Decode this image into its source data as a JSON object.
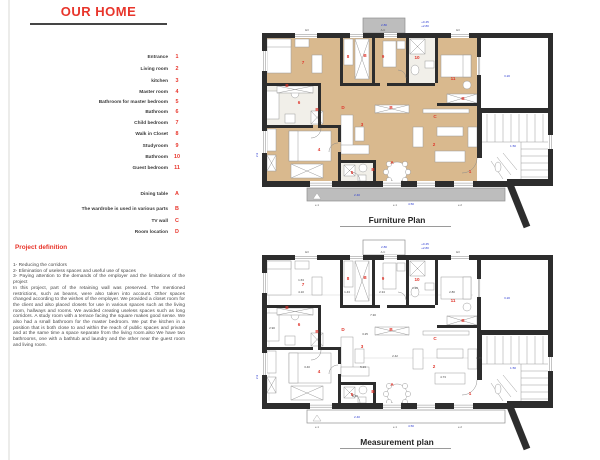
{
  "page": {
    "title": "OUR HOME"
  },
  "colors": {
    "red": "#e0352b",
    "blue": "#2b3bd0",
    "wall": "#2d2d2d",
    "wood": "#d9b98e",
    "gray": "#bdbdbd",
    "tile": "#f1efe9"
  },
  "legend": {
    "numbered": [
      {
        "label": "Entrance",
        "num": "1",
        "y": 58
      },
      {
        "label": "Living room",
        "num": "2",
        "y": 70
      },
      {
        "label": "kitchen",
        "num": "3",
        "y": 82
      },
      {
        "label": "Master room",
        "num": "4",
        "y": 93
      },
      {
        "label": "Bathroom for master bedroom",
        "num": "5",
        "y": 103
      },
      {
        "label": "Bathroom",
        "num": "6",
        "y": 113
      },
      {
        "label": "Child bedroom",
        "num": "7",
        "y": 124
      },
      {
        "label": "Walk in Closet",
        "num": "8",
        "y": 135
      },
      {
        "label": "Studyroom",
        "num": "9",
        "y": 147
      },
      {
        "label": "Bathroom",
        "num": "10",
        "y": 158
      },
      {
        "label": "Guest bedroom",
        "num": "11",
        "y": 169
      }
    ],
    "lettered": [
      {
        "label": "Dining table",
        "num": "A",
        "y": 195
      },
      {
        "label": "The wardrobe is used in various parts",
        "num": "B",
        "y": 210
      },
      {
        "label": "TV wall",
        "num": "C",
        "y": 222
      },
      {
        "label": "Room location",
        "num": "D",
        "y": 233
      }
    ]
  },
  "project": {
    "heading": "Project definition",
    "list": [
      "1- Reducing the corridors",
      "2- Elimination of useless spaces and useful use of spaces",
      "3- Paying attention to the demands of the employer and the limitations of the project"
    ],
    "body": "In this project, part of the retaining wall was preserved. The mentioned restrictions, such as beams, were also taken into account. Other spaces changed according to the wishes of the employer. We provided a closet room for the client and also placed closets for use in various spaces such as the living room, hallways and rooms. We avoided creating useless spaces such as long corridors. A study room with a terrace facing the square makes good sense. We also had a small bathroom for the master bedroom. We put the kitchen in a position that is both close to and within the reach of public spaces and private and at the same time a space separate from the living room.also We have two bathrooms, one with a bathtub and laundry and the other near the guest room and living room."
  },
  "plans": [
    {
      "id": "furniture",
      "label": "Furniture Plan",
      "origin": [
        255,
        15
      ],
      "filled": true
    },
    {
      "id": "measurement",
      "label": "Measurement plan",
      "origin": [
        255,
        237
      ],
      "filled": false
    }
  ],
  "room_labels": [
    {
      "t": "7",
      "x": 48,
      "y": 49
    },
    {
      "t": "8",
      "x": 93,
      "y": 43
    },
    {
      "t": "B",
      "x": 110,
      "y": 42
    },
    {
      "t": "9",
      "x": 128,
      "y": 43
    },
    {
      "t": "10",
      "x": 162,
      "y": 44
    },
    {
      "t": "11",
      "x": 198,
      "y": 65
    },
    {
      "t": "B",
      "x": 32,
      "y": 72
    },
    {
      "t": "6",
      "x": 44,
      "y": 89
    },
    {
      "t": "B",
      "x": 62,
      "y": 96
    },
    {
      "t": "D",
      "x": 88,
      "y": 94
    },
    {
      "t": "B",
      "x": 136,
      "y": 94
    },
    {
      "t": "C",
      "x": 180,
      "y": 103
    },
    {
      "t": "B",
      "x": 208,
      "y": 85
    },
    {
      "t": "3",
      "x": 107,
      "y": 111
    },
    {
      "t": "2",
      "x": 179,
      "y": 131
    },
    {
      "t": "4",
      "x": 64,
      "y": 136
    },
    {
      "t": "5",
      "x": 97,
      "y": 159
    },
    {
      "t": "B",
      "x": 118,
      "y": 156
    },
    {
      "t": "A",
      "x": 137,
      "y": 149
    },
    {
      "t": "1",
      "x": 215,
      "y": 158
    }
  ],
  "annotations": [
    {
      "t": "2.80",
      "x": 129,
      "y": 11
    },
    {
      "t": "+0.45",
      "x": 170,
      "y": 8
    },
    {
      "t": "+2.80",
      "x": 170,
      "y": 12
    },
    {
      "t": "3.20",
      "x": 252,
      "y": 62
    },
    {
      "t": "2.9",
      "x": 3,
      "y": 140,
      "r": true
    },
    {
      "t": "1.50",
      "x": 258,
      "y": 132
    },
    {
      "t": "2.40",
      "x": 102,
      "y": 181
    },
    {
      "t": "4.50",
      "x": 156,
      "y": 190
    }
  ],
  "tags": [
    {
      "t": "E3",
      "x": 52,
      "y": 16
    },
    {
      "t": "A.C",
      "x": 128,
      "y": 16
    },
    {
      "t": "E3",
      "x": 203,
      "y": 16
    },
    {
      "t": "e.1",
      "x": 62,
      "y": 191
    },
    {
      "t": "e.1",
      "x": 140,
      "y": 191
    },
    {
      "t": "e.2",
      "x": 205,
      "y": 191
    }
  ],
  "dims": [
    {
      "t": "4.10",
      "x": 46,
      "y": 56
    },
    {
      "t": "1.43",
      "x": 92,
      "y": 56
    },
    {
      "t": "2.34",
      "x": 127,
      "y": 56
    },
    {
      "t": "1.20",
      "x": 160,
      "y": 52
    },
    {
      "t": "2.80",
      "x": 197,
      "y": 56
    },
    {
      "t": "7.30",
      "x": 118,
      "y": 79
    },
    {
      "t": "3.25",
      "x": 110,
      "y": 98
    },
    {
      "t": "5.23",
      "x": 108,
      "y": 131
    },
    {
      "t": "2.90",
      "x": 17,
      "y": 92
    },
    {
      "t": "3.40",
      "x": 52,
      "y": 131
    },
    {
      "t": "4.73",
      "x": 188,
      "y": 141
    },
    {
      "t": "2.10",
      "x": 100,
      "y": 160
    },
    {
      "t": "1.85",
      "x": 224,
      "y": 122
    },
    {
      "t": "2.42",
      "x": 140,
      "y": 120
    },
    {
      "t": "1.63",
      "x": 46,
      "y": 44
    }
  ],
  "geometry": {
    "floor": {
      "x": 12,
      "y": 23,
      "w": 210,
      "h": 143
    },
    "tiles": [
      {
        "x": 12,
        "y": 71,
        "w": 51,
        "h": 39
      },
      {
        "x": 154,
        "y": 23,
        "w": 26,
        "h": 45
      },
      {
        "x": 86,
        "y": 148,
        "w": 32,
        "h": 18
      }
    ],
    "terrace": {
      "x": 108,
      "y": 3,
      "w": 42,
      "h": 15
    },
    "balcony": {
      "x": 52,
      "y": 173,
      "w": 198,
      "h": 13
    },
    "walls": [
      {
        "x": 7,
        "y": 18,
        "w": 291,
        "h": 5
      },
      {
        "x": 7,
        "y": 18,
        "w": 5,
        "h": 154
      },
      {
        "x": 7,
        "y": 166,
        "w": 246,
        "h": 6
      },
      {
        "x": 293,
        "y": 18,
        "w": 5,
        "h": 80
      },
      {
        "x": 222,
        "y": 93,
        "w": 76,
        "h": 5
      },
      {
        "x": 222,
        "y": 93,
        "w": 5,
        "h": 50
      },
      {
        "x": 293,
        "y": 93,
        "w": 5,
        "h": 77
      },
      {
        "x": 252,
        "y": 164,
        "w": 46,
        "h": 7
      },
      {
        "x": 222,
        "y": 18,
        "w": 4,
        "h": 77
      },
      {
        "x": 85,
        "y": 20,
        "w": 3,
        "h": 48
      },
      {
        "x": 117,
        "y": 20,
        "w": 3,
        "h": 48
      },
      {
        "x": 151,
        "y": 20,
        "w": 3,
        "h": 48
      },
      {
        "x": 180,
        "y": 20,
        "w": 3,
        "h": 48
      },
      {
        "x": 10,
        "y": 68,
        "w": 55,
        "h": 3
      },
      {
        "x": 63,
        "y": 68,
        "w": 3,
        "h": 45
      },
      {
        "x": 85,
        "y": 68,
        "w": 40,
        "h": 3
      },
      {
        "x": 132,
        "y": 68,
        "w": 48,
        "h": 3
      },
      {
        "x": 182,
        "y": 88,
        "w": 40,
        "h": 3
      },
      {
        "x": 10,
        "y": 110,
        "w": 48,
        "h": 3
      },
      {
        "x": 66,
        "y": 110,
        "w": 17,
        "h": 3
      },
      {
        "x": 83,
        "y": 110,
        "w": 3,
        "h": 17
      },
      {
        "x": 83,
        "y": 137,
        "w": 3,
        "h": 31
      },
      {
        "x": 118,
        "y": 145,
        "w": 3,
        "h": 23
      },
      {
        "x": 86,
        "y": 145,
        "w": 35,
        "h": 3
      }
    ],
    "diag": {
      "x1": 254,
      "y1": 167,
      "x2": 272,
      "y2": 212,
      "w": 7
    },
    "windows": [
      {
        "x": 40,
        "y": 18,
        "w": 22,
        "h": 5,
        "o": "h"
      },
      {
        "x": 95,
        "y": 18,
        "w": 13,
        "h": 5,
        "o": "h"
      },
      {
        "x": 129,
        "y": 18,
        "w": 13,
        "h": 5,
        "o": "h"
      },
      {
        "x": 196,
        "y": 18,
        "w": 18,
        "h": 5,
        "o": "h"
      },
      {
        "x": 7,
        "y": 36,
        "w": 5,
        "h": 20,
        "o": "v"
      },
      {
        "x": 7,
        "y": 116,
        "w": 5,
        "h": 22,
        "o": "v"
      },
      {
        "x": 55,
        "y": 166,
        "w": 22,
        "h": 6,
        "o": "h"
      },
      {
        "x": 128,
        "y": 166,
        "w": 18,
        "h": 6,
        "o": "h"
      },
      {
        "x": 162,
        "y": 166,
        "w": 18,
        "h": 6,
        "o": "h"
      },
      {
        "x": 199,
        "y": 166,
        "w": 19,
        "h": 6,
        "o": "h"
      },
      {
        "x": 222,
        "y": 42,
        "w": 4,
        "h": 18,
        "o": "v"
      },
      {
        "x": 293,
        "y": 120,
        "w": 5,
        "h": 14,
        "o": "v"
      }
    ],
    "furniture": [
      {
        "k": "r",
        "x": 12,
        "y": 24,
        "w": 24,
        "h": 34
      },
      {
        "k": "r",
        "x": 12,
        "y": 24,
        "w": 24,
        "h": 8
      },
      {
        "k": "r",
        "x": 40,
        "y": 24,
        "w": 14,
        "h": 8
      },
      {
        "k": "r",
        "x": 57,
        "y": 40,
        "w": 10,
        "h": 18
      },
      {
        "k": "x",
        "x": 100,
        "y": 24,
        "w": 14,
        "h": 40
      },
      {
        "k": "r",
        "x": 89,
        "y": 24,
        "w": 9,
        "h": 26
      },
      {
        "k": "r",
        "x": 128,
        "y": 26,
        "w": 13,
        "h": 26
      },
      {
        "k": "r",
        "x": 142,
        "y": 26,
        "w": 8,
        "h": 8
      },
      {
        "k": "x",
        "x": 155,
        "y": 24,
        "w": 15,
        "h": 15
      },
      {
        "k": "e",
        "cx": 160,
        "cy": 55,
        "rx": 4,
        "ry": 5
      },
      {
        "k": "r",
        "x": 170,
        "y": 46,
        "w": 9,
        "h": 7
      },
      {
        "k": "r",
        "x": 186,
        "y": 40,
        "w": 30,
        "h": 22
      },
      {
        "k": "r",
        "x": 208,
        "y": 40,
        "w": 8,
        "h": 22
      },
      {
        "k": "e",
        "cx": 212,
        "cy": 70,
        "rx": 4,
        "ry": 4
      },
      {
        "k": "r",
        "x": 11,
        "y": 76,
        "w": 13,
        "h": 28
      },
      {
        "k": "e",
        "cx": 40,
        "cy": 78,
        "rx": 4,
        "ry": 5
      },
      {
        "k": "r",
        "x": 30,
        "y": 99,
        "w": 10,
        "h": 9
      },
      {
        "k": "x",
        "x": 22,
        "y": 71,
        "w": 36,
        "h": 7
      },
      {
        "k": "x",
        "x": 56,
        "y": 96,
        "w": 12,
        "h": 13
      },
      {
        "k": "r",
        "x": 34,
        "y": 116,
        "w": 42,
        "h": 30
      },
      {
        "k": "r",
        "x": 34,
        "y": 116,
        "w": 9,
        "h": 30
      },
      {
        "k": "x",
        "x": 36,
        "y": 149,
        "w": 32,
        "h": 14
      },
      {
        "k": "r",
        "x": 12,
        "y": 114,
        "w": 9,
        "h": 22
      },
      {
        "k": "x",
        "x": 12,
        "y": 140,
        "w": 9,
        "h": 16
      },
      {
        "k": "r",
        "x": 86,
        "y": 100,
        "w": 12,
        "h": 38
      },
      {
        "k": "r",
        "x": 86,
        "y": 130,
        "w": 28,
        "h": 9
      },
      {
        "k": "r",
        "x": 100,
        "y": 112,
        "w": 9,
        "h": 14
      },
      {
        "k": "r",
        "x": 168,
        "y": 94,
        "w": 46,
        "h": 4
      },
      {
        "k": "x",
        "x": 192,
        "y": 79,
        "w": 30,
        "h": 9
      },
      {
        "k": "x",
        "x": 120,
        "y": 90,
        "w": 34,
        "h": 8
      },
      {
        "k": "x",
        "x": 89,
        "y": 150,
        "w": 11,
        "h": 11
      },
      {
        "k": "e",
        "cx": 108,
        "cy": 153,
        "rx": 4,
        "ry": 4
      },
      {
        "k": "r",
        "x": 103,
        "y": 160,
        "w": 8,
        "h": 6
      },
      {
        "k": "r",
        "x": 158,
        "y": 112,
        "w": 10,
        "h": 20
      },
      {
        "k": "r",
        "x": 213,
        "y": 112,
        "w": 9,
        "h": 20
      },
      {
        "k": "r",
        "x": 180,
        "y": 136,
        "w": 30,
        "h": 11
      },
      {
        "k": "r",
        "x": 182,
        "y": 112,
        "w": 26,
        "h": 9
      },
      {
        "k": "c",
        "cx": 142,
        "cy": 157,
        "r": 10
      },
      {
        "k": "c",
        "cx": 134,
        "cy": 149,
        "r": 2.6
      },
      {
        "k": "c",
        "cx": 150,
        "cy": 149,
        "r": 2.6
      },
      {
        "k": "c",
        "cx": 131,
        "cy": 157,
        "r": 2.6
      },
      {
        "k": "c",
        "cx": 153,
        "cy": 157,
        "r": 2.6
      },
      {
        "k": "c",
        "cx": 134,
        "cy": 165,
        "r": 2.6
      },
      {
        "k": "c",
        "cx": 150,
        "cy": 165,
        "r": 2.6
      },
      {
        "k": "e",
        "cx": 243,
        "cy": 152,
        "rx": 3,
        "ry": 5
      }
    ],
    "arcs": [
      "M 66 113 A 10 10 0 0 1 56 123",
      "M 83 128 A 9 9 0 0 0 74 137",
      "M 143 55 A 8 8 0 0 1 151 63",
      "M 222 143 A 15 15 0 0 1 207 158",
      "M 105 166 A 9 9 0 0 0 96 157"
    ],
    "stairs": {
      "v": {
        "x0": 232,
        "x1": 288,
        "step": 8,
        "y0": 99,
        "y1": 127
      },
      "h": {
        "y0": 134,
        "y1": 162,
        "step": 7,
        "x0": 266,
        "x1": 293
      },
      "extra": [
        [
          227,
          127,
          293,
          127
        ],
        [
          266,
          127,
          266,
          165
        ]
      ],
      "fan": [
        [
          236,
          146,
          248,
          164
        ],
        [
          242,
          142,
          256,
          160
        ],
        [
          248,
          138,
          262,
          155
        ]
      ]
    },
    "dimlines": [
      [
        12,
        58,
        218,
        58
      ],
      [
        14,
        22,
        14,
        164
      ],
      [
        108,
        121,
        215,
        121
      ]
    ]
  }
}
